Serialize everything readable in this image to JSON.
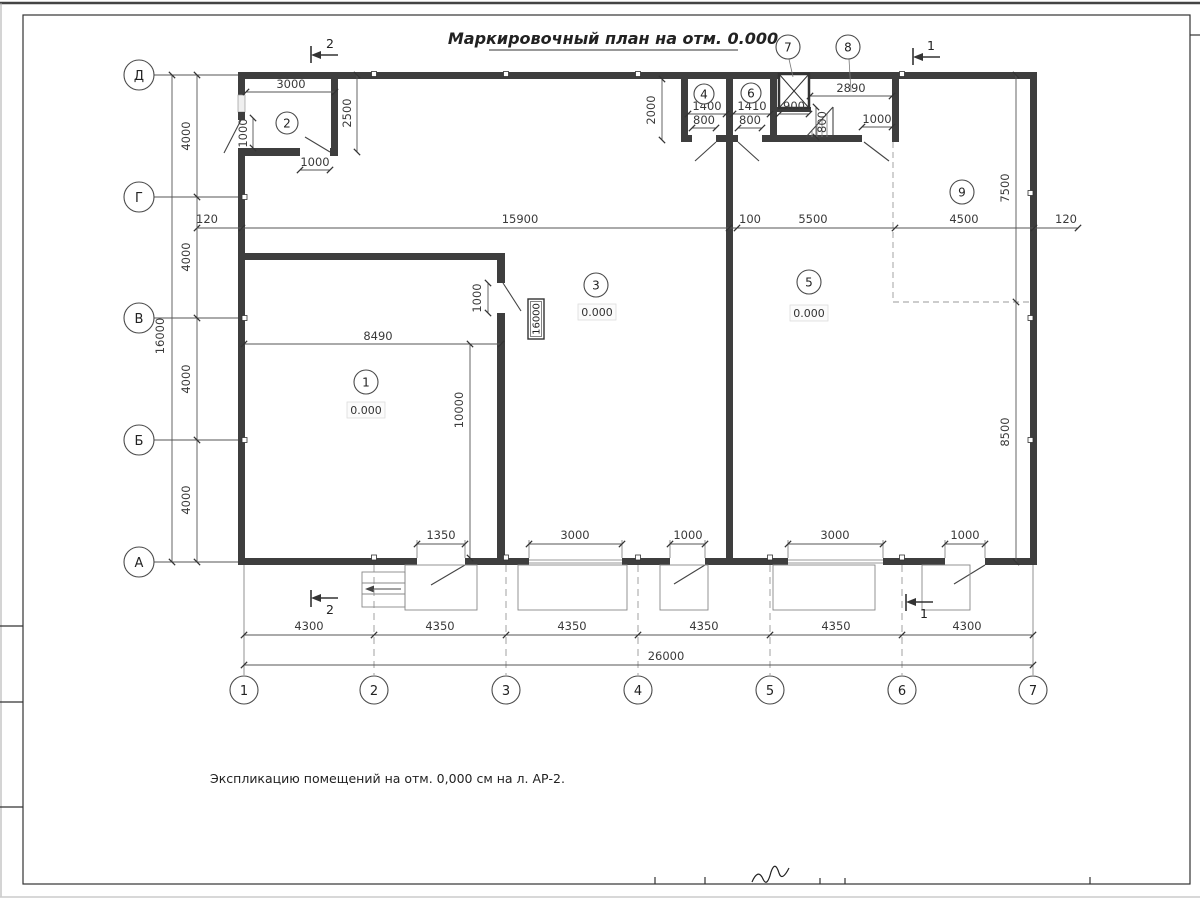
{
  "sheet": {
    "title": "Маркировочный план на отм. 0.000",
    "note": "Экспликацию помещений на отм. 0,000 см на л. АР-2."
  },
  "axes": {
    "rows": [
      "Д",
      "Г",
      "В",
      "Б",
      "А"
    ],
    "cols": [
      "1",
      "2",
      "3",
      "4",
      "5",
      "6",
      "7"
    ]
  },
  "sections": {
    "s1": "1",
    "s2": "2"
  },
  "rooms": {
    "r1": "1",
    "r2": "2",
    "r3": "3",
    "r4": "4",
    "r5": "5",
    "r6": "6",
    "r7": "7",
    "r8": "8",
    "r9": "9"
  },
  "elevation": "0.000",
  "dims": {
    "room2": {
      "width": "3000",
      "height": "2500",
      "door_left": "1000",
      "door_bottom": "1000"
    },
    "strip": {
      "depth": "2000",
      "room4_width": "1400",
      "room4_door": "800",
      "room6_width": "1410",
      "room6_door": "800",
      "shaft_width": "900",
      "ramp": "800",
      "room8_width": "2890",
      "room8_door": "1000"
    },
    "mid_row": [
      "120",
      "15900",
      "100",
      "5500",
      "4500",
      "120"
    ],
    "left_chain": [
      "4000",
      "4000",
      "4000",
      "4000"
    ],
    "left_total": "16000",
    "right_upper": "7500",
    "right_lower": "8500",
    "room1": {
      "width": "8490",
      "door": "1000",
      "height": "10000",
      "tag": "16000"
    },
    "bottom_openings": [
      "1350",
      "3000",
      "1000",
      "3000",
      "1000"
    ],
    "bottom_chain": [
      "4300",
      "4350",
      "4350",
      "4350",
      "4350",
      "4300"
    ],
    "bottom_total": "26000"
  }
}
